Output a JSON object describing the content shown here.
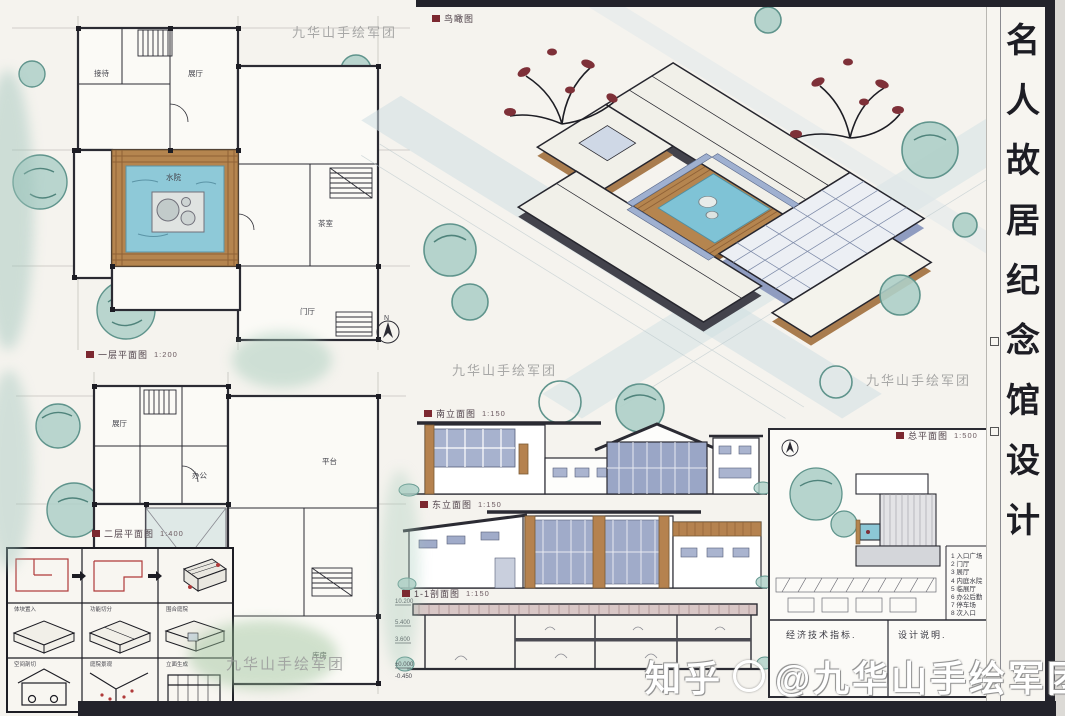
{
  "title": {
    "text": "名人故居纪念馆设计",
    "chars": [
      "名",
      "人",
      "故",
      "居",
      "纪",
      "念",
      "馆",
      "设",
      "计"
    ]
  },
  "captions": {
    "bird_eye": {
      "label": "鸟瞰图",
      "scale": ""
    },
    "plan1": {
      "label": "一层平面图",
      "scale": "1:200"
    },
    "plan2": {
      "label": "二层平面图",
      "scale": "1:400"
    },
    "elev1": {
      "label": "南立面图",
      "scale": "1:150"
    },
    "elev2": {
      "label": "东立面图",
      "scale": "1:150"
    },
    "section": {
      "label": "1-1剖面图",
      "scale": "1:150"
    },
    "site": {
      "label": "总平面图",
      "scale": "1:500"
    }
  },
  "plans": {
    "plan1_rooms": {
      "r1": "接待",
      "r2": "展厅",
      "r3": "水院",
      "r4": "茶室",
      "r5": "门厅"
    },
    "plan2_rooms": {
      "r1": "展厅",
      "r2": "办公",
      "r3": "平台",
      "r4": "库房"
    }
  },
  "section_levels": [
    "10.200",
    "5.400",
    "3.600",
    "±0.000",
    "-0.450"
  ],
  "site_plan": {
    "legend": [
      "1 入口广场",
      "2 门厅",
      "3 展厅",
      "4 内庭水院",
      "5 临展厅",
      "6 办公后勤",
      "7 停车场",
      "8 次入口"
    ],
    "notes_left": "经济技术指标.",
    "notes_right": "设计说明."
  },
  "analysis": {
    "captions": [
      "体块置入",
      "功能切分",
      "围合庭院",
      "空间剖切",
      "庭院景观",
      "立面生成"
    ]
  },
  "compass": {
    "north_label": "N"
  },
  "watermarks": {
    "brand": "九华山手绘军团",
    "zhihu": "知乎",
    "account": "@九华山手绘军团9哥"
  },
  "colors": {
    "line": "#2b2b33",
    "wood": "#b5854f",
    "water": "#7fc3d6",
    "glass": "#9aa6c6",
    "foliage_teal": "#a8cdc5",
    "foliage_red": "#7e3038",
    "label_red": "#7c2830",
    "paper": "#f5f3ee"
  }
}
